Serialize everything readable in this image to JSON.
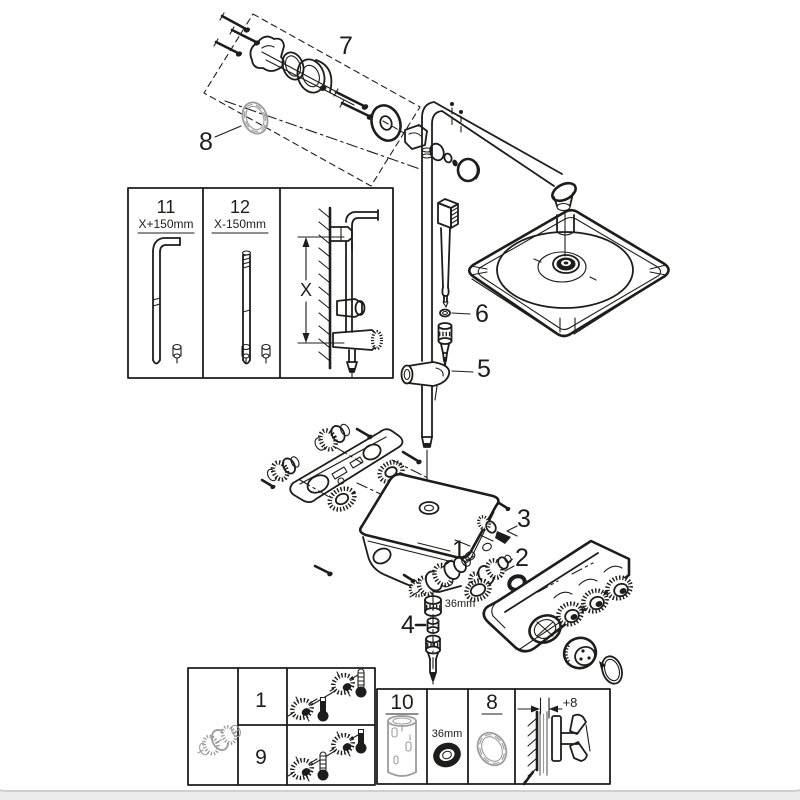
{
  "colors": {
    "ink": "#1d1d1b",
    "grey": "#9b9b9c",
    "paper": "#ffffff",
    "page_bg": "#ebebeb"
  },
  "callouts": {
    "wall_union_group": "7",
    "wall_ring": "8",
    "handshower_seal": "6",
    "glide_holder": "5",
    "cartridge_right": "3",
    "cartridge_main": "1",
    "cartridge_mid": "2",
    "check_valve": "4",
    "cap_wrench_size": "36mm"
  },
  "pipe_length_box": {
    "long_pipe_id": "11",
    "long_pipe_dim": "X+150mm",
    "short_pipe_id": "12",
    "short_pipe_dim": "X-150mm",
    "wall_dim": "X"
  },
  "cartridge_table": {
    "row_top_id": "1",
    "row_bottom_id": "9"
  },
  "accessory_row": {
    "extension_id": "10",
    "wrench_size": "36mm",
    "ring_id": "8",
    "offset_dim": "+8"
  }
}
